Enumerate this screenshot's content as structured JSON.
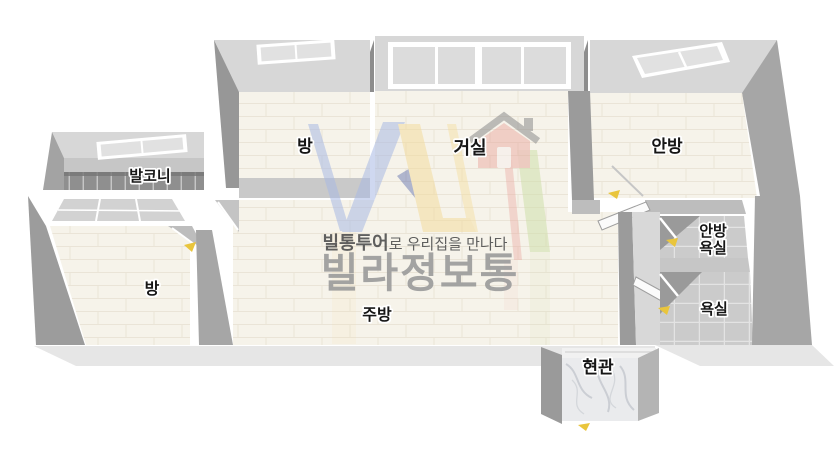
{
  "watermark": {
    "slogan_bold": "빌통투어",
    "slogan_rest": "로 우리집을 만나다",
    "brand": "빌라정보통"
  },
  "rooms": {
    "balcony": "발코니",
    "bedroom_top": "방",
    "living": "거실",
    "master": "안방",
    "master_bath_line1": "안방",
    "master_bath_line2": "욕실",
    "bath": "욕실",
    "bedroom_bottom": "방",
    "kitchen": "주방",
    "entrance": "현관"
  },
  "colors": {
    "background": "#ffffff",
    "wall_light": "#d7d7d7",
    "wall_mid": "#bdbdbd",
    "wall_dark": "#9b9b9b",
    "wall_side": "#a6a6a6",
    "floor_cream": "#f6f3ea",
    "floor_line": "#eae4d7",
    "tile_gray": "#cbcbcb",
    "tile_grout": "#e3e3e3",
    "balcony_tile": "#8f8f8f",
    "fascia": "#e6e6e6",
    "marble": "#eaebed",
    "label": "#161616",
    "label_outline": "#ffffff",
    "slogan": "#4f4f4f",
    "brand": "#9b9b9b",
    "logo_blue": "#a9bae4",
    "logo_navy": "#5565a8",
    "logo_yellow": "#f3dc9e",
    "logo_green": "#cfe0ab",
    "logo_red": "#e8a29b",
    "door_marker": "#e9c53c"
  }
}
